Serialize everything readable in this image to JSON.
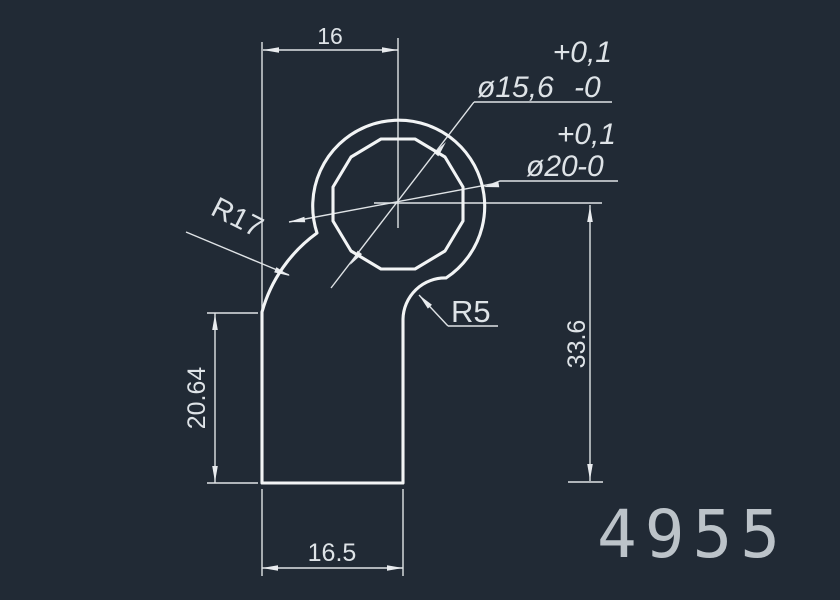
{
  "drawing": {
    "title": "CAD profile drawing",
    "background": "#212a35",
    "line_color": "#f2f4f5",
    "text_color": "#dee3e7",
    "part_number": "4955",
    "part_number_color": "#bcc3c9",
    "dimensions": {
      "top_width": "16",
      "bottom_width": "16.5",
      "left_height": "20.64",
      "right_height": "33.6"
    },
    "radius_labels": {
      "left": "R17",
      "right": "R5"
    },
    "diameter_labels": {
      "inner": {
        "value": "ø15,6",
        "upper_tolerance": "+0,1",
        "lower_tolerance": "-0"
      },
      "outer": {
        "value": "ø20",
        "upper_tolerance": "+0,1",
        "lower_tolerance": "-0"
      }
    }
  }
}
